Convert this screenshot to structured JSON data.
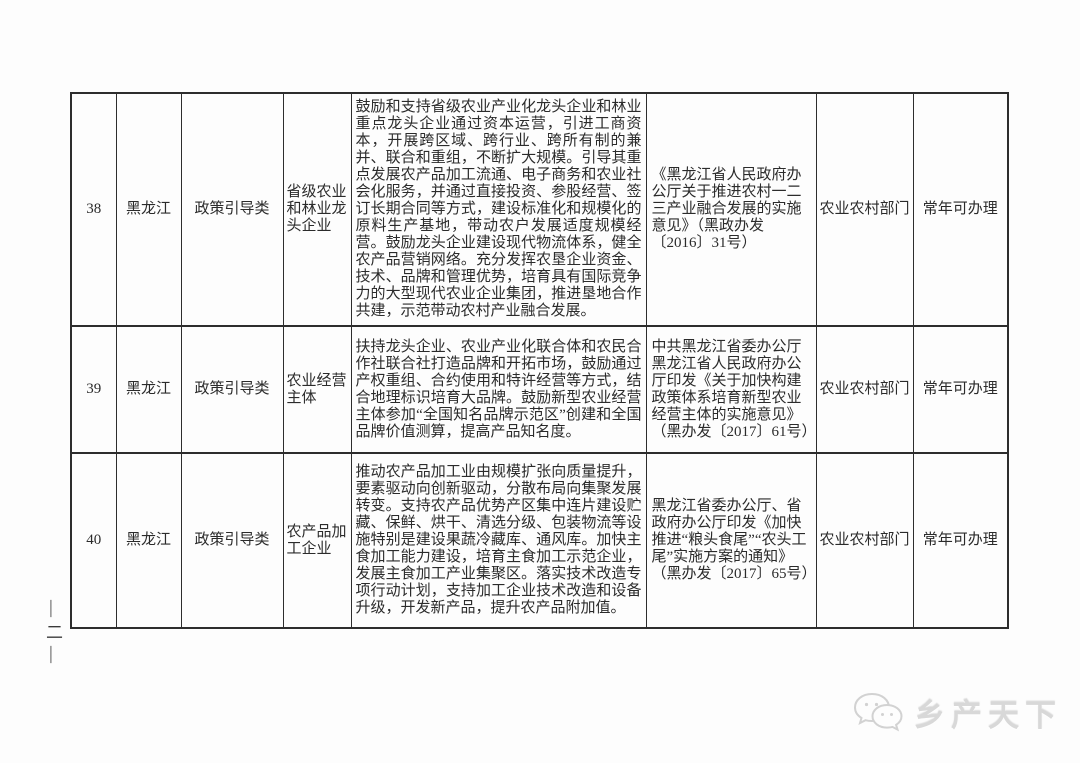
{
  "page": {
    "page_number_marker": "—二—",
    "background_color": "#fdfdfd",
    "text_color": "#2b2b2b",
    "table_border_color": "#2d2d2d",
    "watermark": {
      "icon": "wechat-chat-bubbles-icon",
      "text": "乡产天下",
      "color": "#d8d8d8"
    }
  },
  "table": {
    "rows": [
      {
        "index": "38",
        "province": "黑龙江",
        "category": "政策引导类",
        "subject": "省级农业和林业龙头企业",
        "measures": "鼓励和支持省级农业产业化龙头企业和林业重点龙头企业通过资本运营，引进工商资本，开展跨区域、跨行业、跨所有制的兼并、联合和重组，不断扩大规模。引导其重点发展农产品加工流通、电子商务和农业社会化服务，并通过直接投资、参股经营、签订长期合同等方式，建设标准化和规模化的原料生产基地，带动农户发展适度规模经营。鼓励龙头企业建设现代物流体系，健全农产品营销网络。充分发挥农垦企业资金、技术、品牌和管理优势，培育具有国际竞争力的大型现代农业企业集团，推进垦地合作共建，示范带动农村产业融合发展。",
        "policy_basis": "《黑龙江省人民政府办公厅关于推进农村一二三产业融合发展的实施意见》（黑政办发〔2016〕31号）",
        "department": "农业农村部门",
        "availability": "常年可办理"
      },
      {
        "index": "39",
        "province": "黑龙江",
        "category": "政策引导类",
        "subject": "农业经营主体",
        "measures": "扶持龙头企业、农业产业化联合体和农民合作社联合社打造品牌和开拓市场，鼓励通过产权重组、合约使用和特许经营等方式，结合地理标识培育大品牌。鼓励新型农业经营主体参加“全国知名品牌示范区”创建和全国品牌价值测算，提高产品知名度。",
        "policy_basis": "中共黑龙江省委办公厅黑龙江省人民政府办公厅印发《关于加快构建政策体系培育新型农业经营主体的实施意见》（黑办发〔2017〕61号）",
        "department": "农业农村部门",
        "availability": "常年可办理"
      },
      {
        "index": "40",
        "province": "黑龙江",
        "category": "政策引导类",
        "subject": "农产品加工企业",
        "measures": "推动农产品加工业由规模扩张向质量提升，要素驱动向创新驱动，分散布局向集聚发展转变。支持农产品优势产区集中连片建设贮藏、保鲜、烘干、清选分级、包装物流等设施特别是建设果蔬冷藏库、通风库。加快主食加工能力建设，培育主食加工示范企业，发展主食加工产业集聚区。落实技术改造专项行动计划，支持加工企业技术改造和设备升级，开发新产品，提升农产品附加值。",
        "policy_basis": "黑龙江省委办公厅、省政府办公厅印发《加快推进“粮头食尾”“农头工尾”实施方案的通知》（黑办发〔2017〕65号）",
        "department": "农业农村部门",
        "availability": "常年可办理"
      }
    ]
  }
}
